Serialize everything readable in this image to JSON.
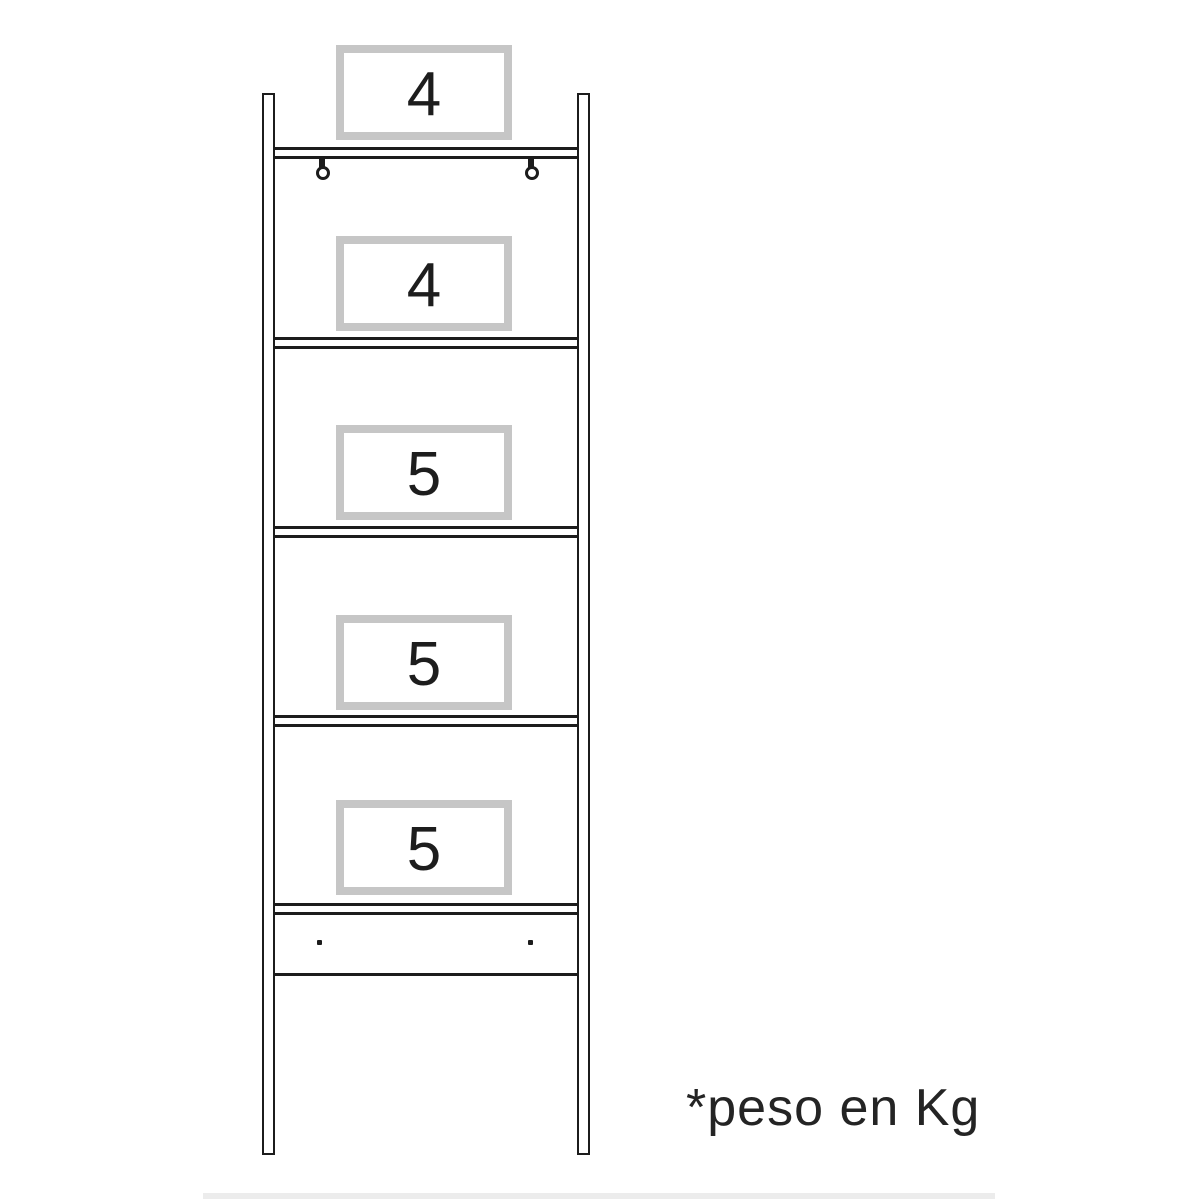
{
  "shelving_unit": {
    "shelf_weight_labels": [
      {
        "label": "4"
      },
      {
        "label": "4"
      },
      {
        "label": "5"
      },
      {
        "label": "5"
      },
      {
        "label": "5"
      }
    ],
    "footnote": "*peso en Kg",
    "icons": {
      "left_hook": "mounting-hook-icon",
      "right_hook": "mounting-hook-icon",
      "left_screw": "screw-dot-icon",
      "right_screw": "screw-dot-icon"
    },
    "colors": {
      "outline": "#1c1c1c",
      "label_box_border": "#c6c6c6",
      "text": "#242424",
      "background": "#ffffff"
    }
  }
}
